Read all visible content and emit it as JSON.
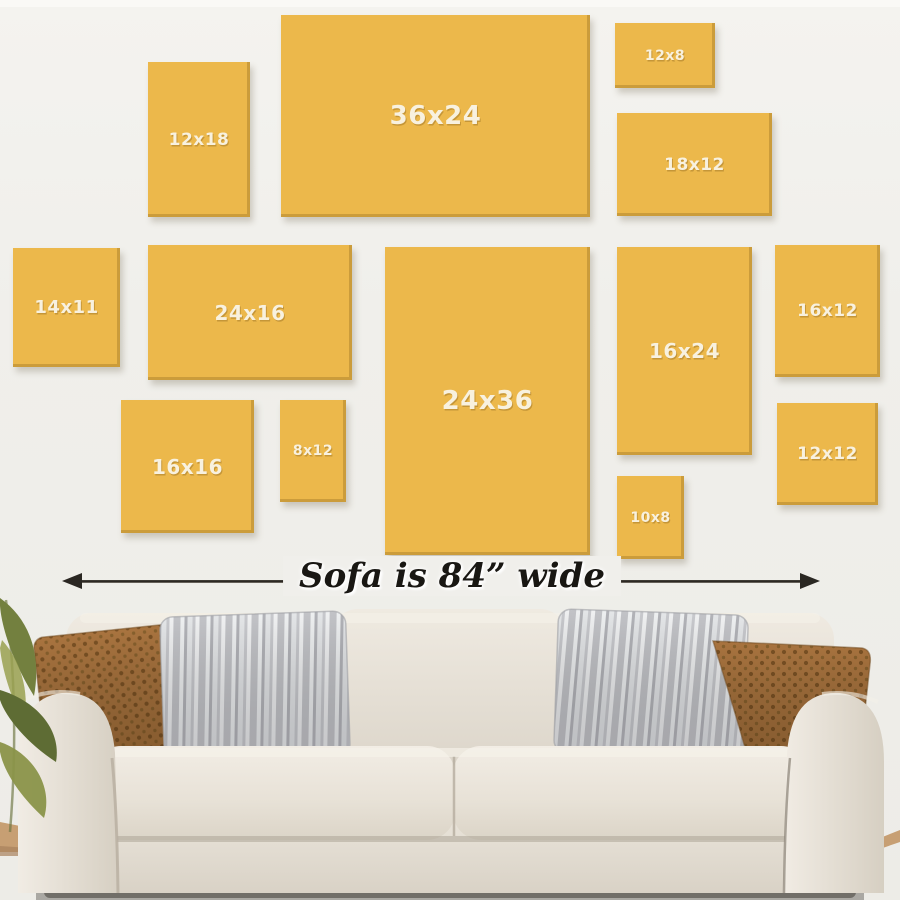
{
  "scene": {
    "wall_color": "#f0efeb",
    "caption": {
      "text": "Sofa is 84” wide",
      "text_color": "#191713",
      "arrow_color": "#2a2722"
    },
    "frames": {
      "fill_color": "#ecb84b",
      "edge_shadow_color": "#a6802c",
      "label_color": "#f8f1df",
      "items": [
        {
          "label": "12x18",
          "x": 148,
          "y": 62,
          "w": 102,
          "h": 155
        },
        {
          "label": "36x24",
          "x": 281,
          "y": 15,
          "w": 309,
          "h": 202
        },
        {
          "label": "12x8",
          "x": 615,
          "y": 23,
          "w": 100,
          "h": 65
        },
        {
          "label": "18x12",
          "x": 617,
          "y": 113,
          "w": 155,
          "h": 103
        },
        {
          "label": "14x11",
          "x": 13,
          "y": 248,
          "w": 107,
          "h": 119
        },
        {
          "label": "24x16",
          "x": 148,
          "y": 245,
          "w": 204,
          "h": 135
        },
        {
          "label": "24x36",
          "x": 385,
          "y": 247,
          "w": 205,
          "h": 308
        },
        {
          "label": "16x24",
          "x": 617,
          "y": 247,
          "w": 135,
          "h": 208
        },
        {
          "label": "16x12",
          "x": 775,
          "y": 245,
          "w": 105,
          "h": 132
        },
        {
          "label": "16x16",
          "x": 121,
          "y": 400,
          "w": 133,
          "h": 133
        },
        {
          "label": "8x12",
          "x": 280,
          "y": 400,
          "w": 66,
          "h": 102
        },
        {
          "label": "12x12",
          "x": 777,
          "y": 403,
          "w": 101,
          "h": 102
        },
        {
          "label": "10x8",
          "x": 617,
          "y": 476,
          "w": 67,
          "h": 83
        }
      ]
    },
    "sofa": {
      "body_color": "#e7e1d8",
      "pillow_brown_color": "#a9743f",
      "pillow_gray_color": "#d6d7da",
      "plant_color": "#73803f",
      "floor_color": "#c79f73"
    }
  }
}
